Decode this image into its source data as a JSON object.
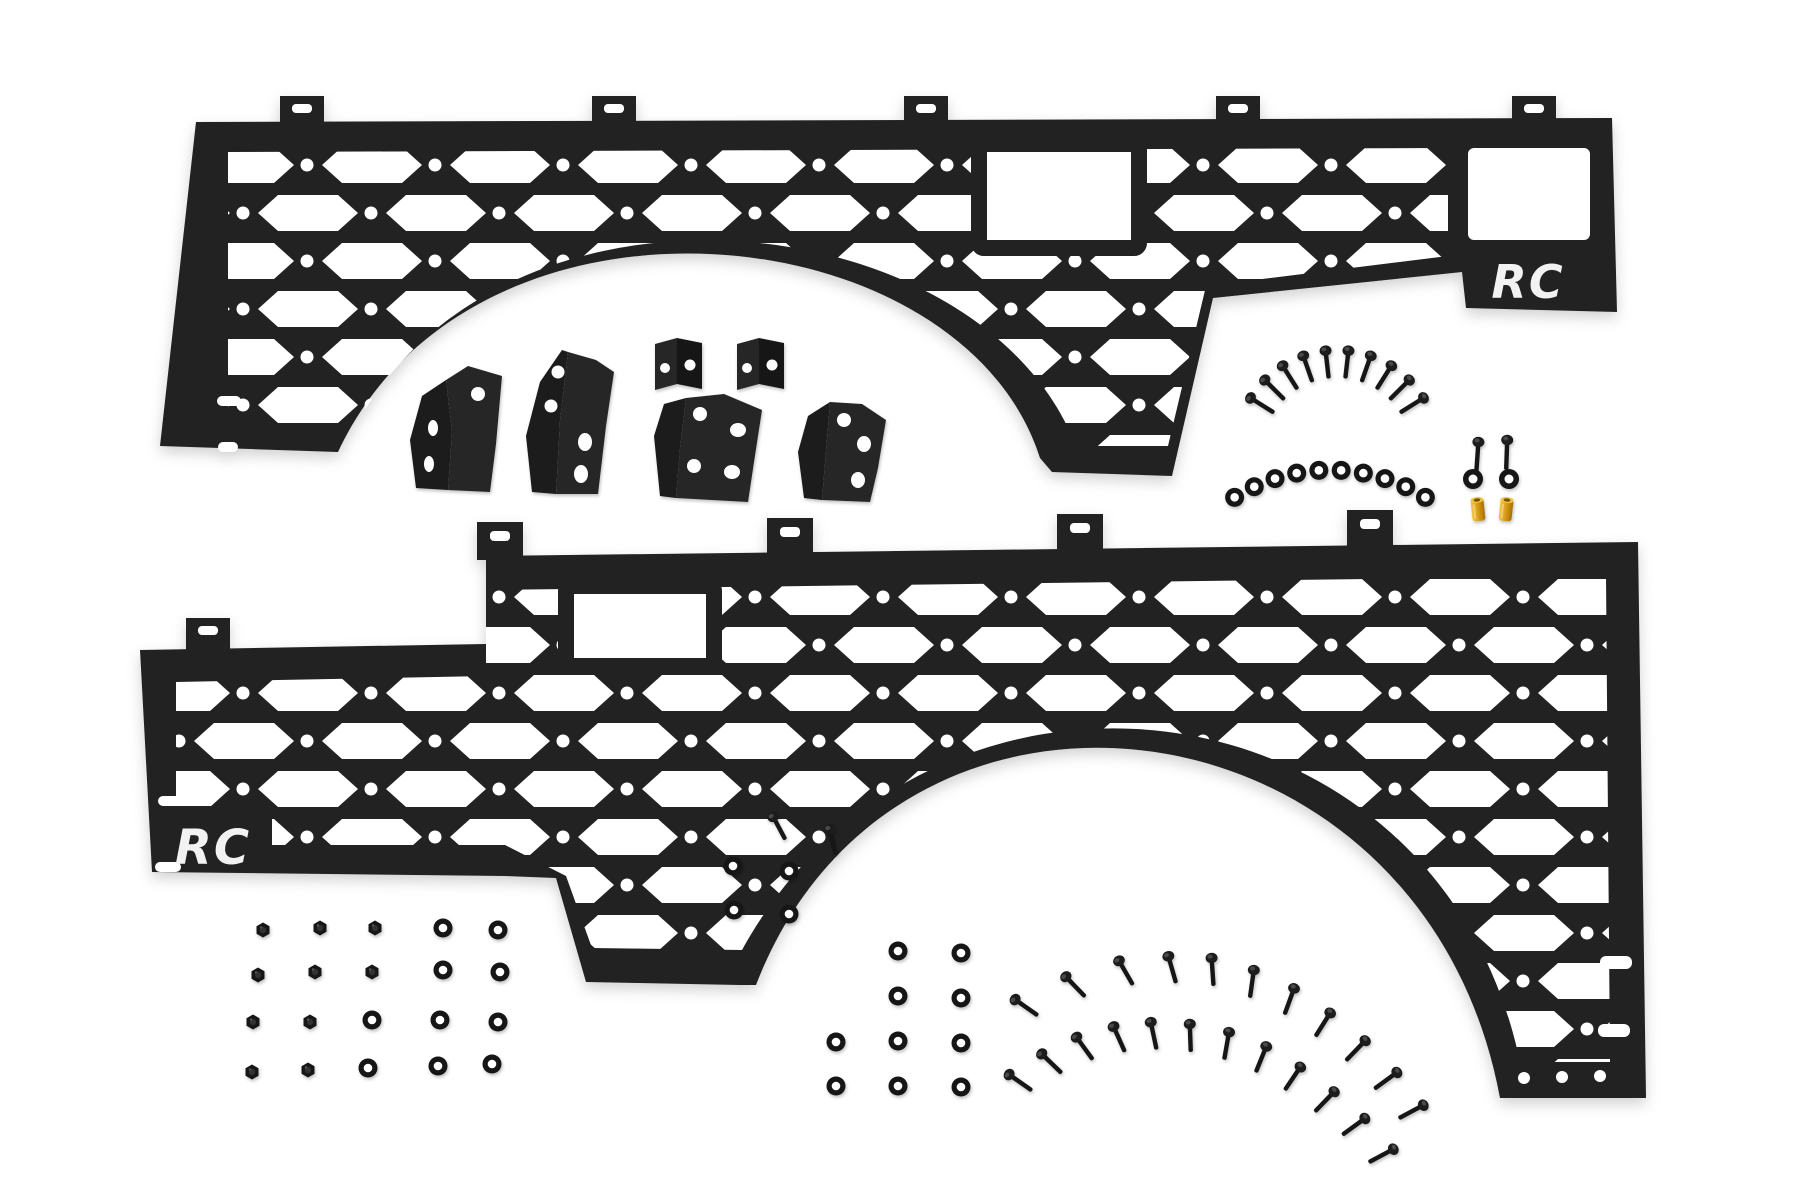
{
  "image_type": "product-photo",
  "scene_description": "Two black hex-grid truck bed molle panels with mounting brackets and hardware kit on a white background",
  "background_color": "#ffffff",
  "branding": {
    "logo_text": "RC",
    "logo_color": "#f2f2f2"
  },
  "colors": {
    "panel": "#212121",
    "panel_face_dark": "#1a1a1a",
    "panel_face_light": "#272727",
    "hardware": "#181818",
    "brass": "#d79a16",
    "background": "#ffffff"
  },
  "panels": {
    "top": {
      "name": "driver-side molle bed panel",
      "logo_text": "RC",
      "mounting_tabs": 5,
      "rect_cutouts": 1,
      "wheel_arch_cutouts": 1
    },
    "bottom": {
      "name": "passenger-side molle bed panel",
      "logo_text": "RC",
      "mounting_tabs": 5,
      "rect_cutouts": 1,
      "wheel_arch_cutouts": 1
    }
  },
  "brackets": {
    "angled_brackets": 4,
    "channel_clips": 2
  },
  "hardware": {
    "top_right": {
      "arc_screws": 10,
      "arc_washers": 10,
      "pair_screws": 2,
      "pair_washers": 2,
      "brass_rivet_nuts": 2
    },
    "bottom_left_grid": {
      "nuts": 10,
      "washers": 10
    },
    "bottom_center": {
      "screws": 2,
      "washers": 14
    },
    "bottom_right_arcs": {
      "outer_screws": 11,
      "inner_screws": 12
    }
  }
}
